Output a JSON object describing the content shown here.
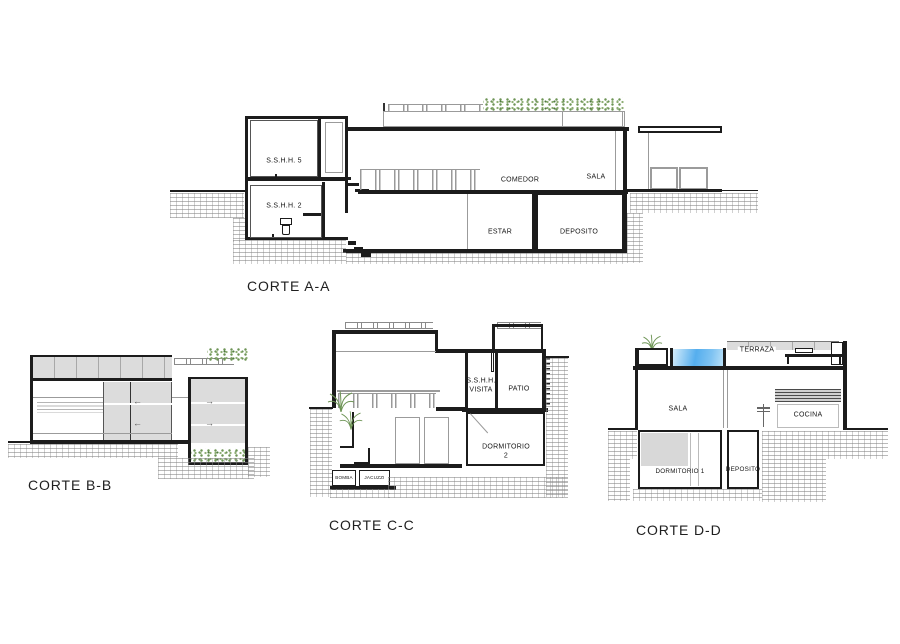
{
  "colors": {
    "wall": "#1c1c1c",
    "panel_gray": "#dcdcdc",
    "line_gray": "#9b9b9b",
    "pool_blue": "#55aeee",
    "plant_green": "#76985c",
    "hatch_gray": "#c2c2c2",
    "background": "#ffffff"
  },
  "icons": {
    "arrow_left": "←",
    "arrow_right": "→"
  },
  "corte_aa": {
    "title": "CORTE A-A",
    "labels": {
      "sshh5": "S.S.H.H. 5",
      "sshh2": "S.S.H.H. 2",
      "comedor": "COMEDOR",
      "sala": "SALA",
      "estar": "ESTAR",
      "deposito": "DEPOSITO"
    }
  },
  "corte_bb": {
    "title": "CORTE B-B"
  },
  "corte_cc": {
    "title": "CORTE C-C",
    "labels": {
      "sshh_visita_line1": "S.S.H.H.",
      "sshh_visita_line2": "VISITA",
      "patio": "PATIO",
      "dormitorio_line1": "DORMITORIO",
      "dormitorio_line2": "2",
      "bomba": "BOMBA",
      "jacuzzi": "JACUZZI"
    }
  },
  "corte_dd": {
    "title": "CORTE D-D",
    "labels": {
      "terraza": "TERRAZA",
      "sala": "SALA",
      "cocina": "COCINA",
      "dormitorio1": "DORMITORIO 1",
      "deposito": "DEPOSITO"
    }
  }
}
